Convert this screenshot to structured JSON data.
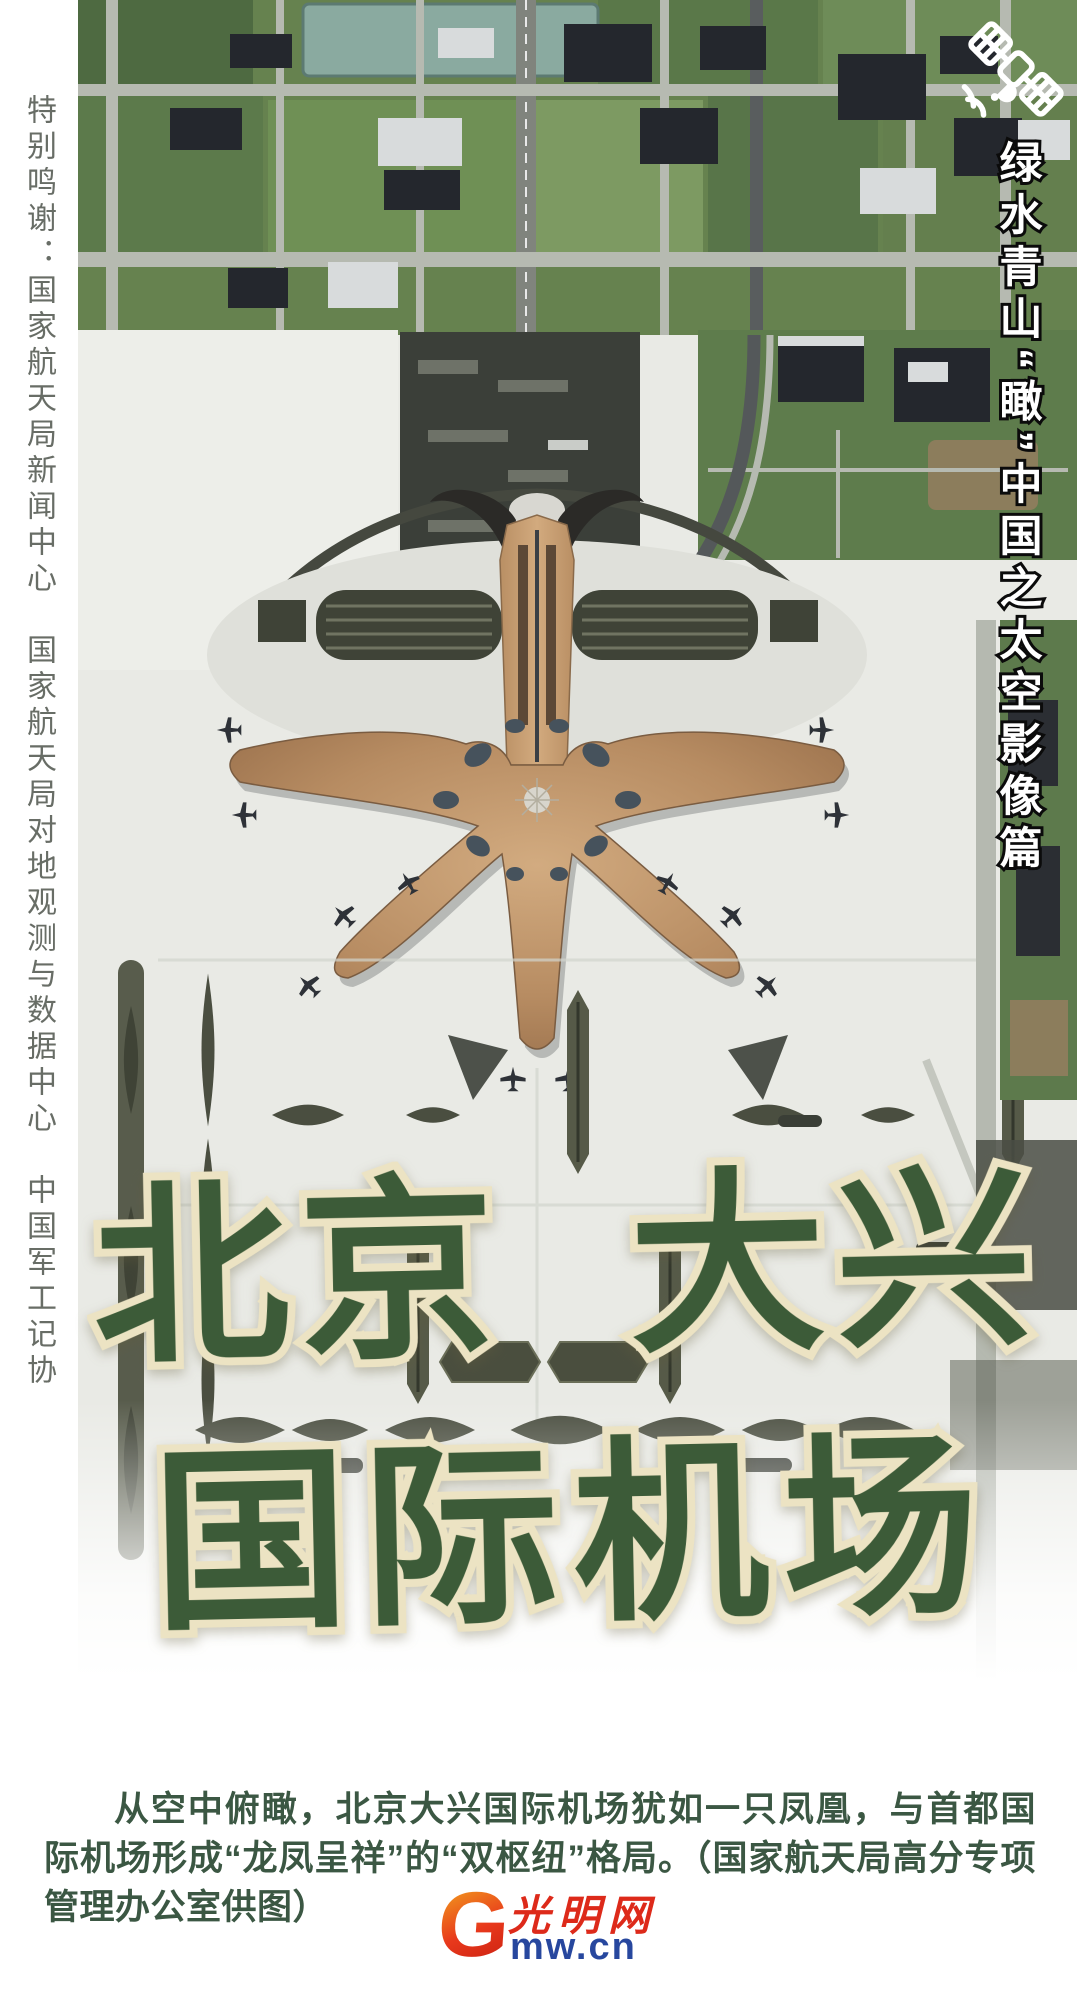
{
  "poster": {
    "left_credits": "特别鸣谢：国家航天局新闻中心　国家航天局对地观测与数据中心　中国军工记协",
    "right_banner": "绿水青山“瞰”中国之太空影像篇",
    "title": {
      "line1": "北京 大兴",
      "line2": "国际机场"
    },
    "caption": "从空中俯瞰，北京大兴国际机场犹如一只凤凰，与首都国际机场形成“龙凤呈祥”的“双枢纽”格局。（国家航天局高分专项管理办公室供图）",
    "logo": {
      "g": "G",
      "cn": "光明网",
      "en": "mw.cn"
    },
    "icons": {
      "satellite": "satellite-icon"
    },
    "colors": {
      "title_green": "#3c5b38",
      "title_outline": "#ece3c3",
      "caption_green": "#3b5743",
      "credits_gray": "#686d66",
      "banner_white": "#ffffff",
      "banner_outline": "#0b0b0b",
      "logo_red": "#e23a1b",
      "logo_blue": "#27479e",
      "terminal_copper": "#b78c62"
    }
  }
}
